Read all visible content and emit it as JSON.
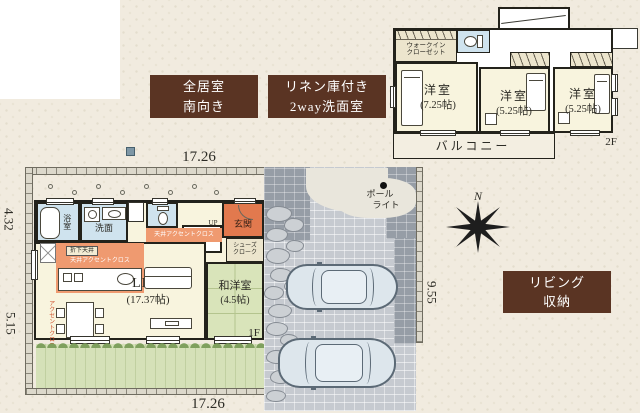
{
  "colors": {
    "background": "#f1ebdf",
    "badge_brown": "#5a3423",
    "accent_orange": "#ef9a70",
    "entrance_orange": "#e2794e",
    "room_cream": "#f8f4de",
    "water_blue": "#cfe3ee",
    "tatami_green": "#d9e4ba",
    "garden_green": "#d5e1b8",
    "paving_gray": "#c6cad0",
    "paving_dark": "#969da6"
  },
  "badges": {
    "south": {
      "line1": "全居室",
      "line2": "南向き"
    },
    "linen": {
      "line1": "リネン庫付き",
      "line2": "2way洗面室"
    },
    "living_storage": {
      "line1": "リビング",
      "line2": "収納"
    }
  },
  "dimensions": {
    "top": "17.26",
    "left_upper": "4.32",
    "left_lower": "5.15",
    "right": "9.55",
    "bottom": "17.26"
  },
  "compass": {
    "north": "N"
  },
  "floor2": {
    "label": "2F",
    "stairs": "DN",
    "walk_in_closet": {
      "line1": "ウォークイン",
      "line2": "クローゼット"
    },
    "bedroom1": {
      "name": "洋室",
      "size": "(7.25帖)"
    },
    "bedroom2": {
      "name": "洋室",
      "size": "(5.25帖)"
    },
    "bedroom3": {
      "name": "洋室",
      "size": "(5.25帖)"
    },
    "balcony": "バルコニー"
  },
  "floor1": {
    "label": "1F",
    "stairs": "UP",
    "bath": "浴室",
    "washroom": "洗面",
    "entrance": "玄関",
    "shoe_closet": {
      "line1": "シューズ",
      "line2": "クローク"
    },
    "ldk": {
      "name": "LDK",
      "size": "(17.37帖)"
    },
    "japanese_room": {
      "name": "和洋室",
      "size": "(4.5帖)"
    },
    "ceiling_accent": "天井アクセントクロス",
    "ceiling_accent_kitchen": "天井アクセントクロス",
    "lowered_ceiling": "折下天井",
    "accent_wall": "アクセントクロス",
    "pole_light": {
      "line1": "ポール",
      "line2": "ライト"
    }
  }
}
